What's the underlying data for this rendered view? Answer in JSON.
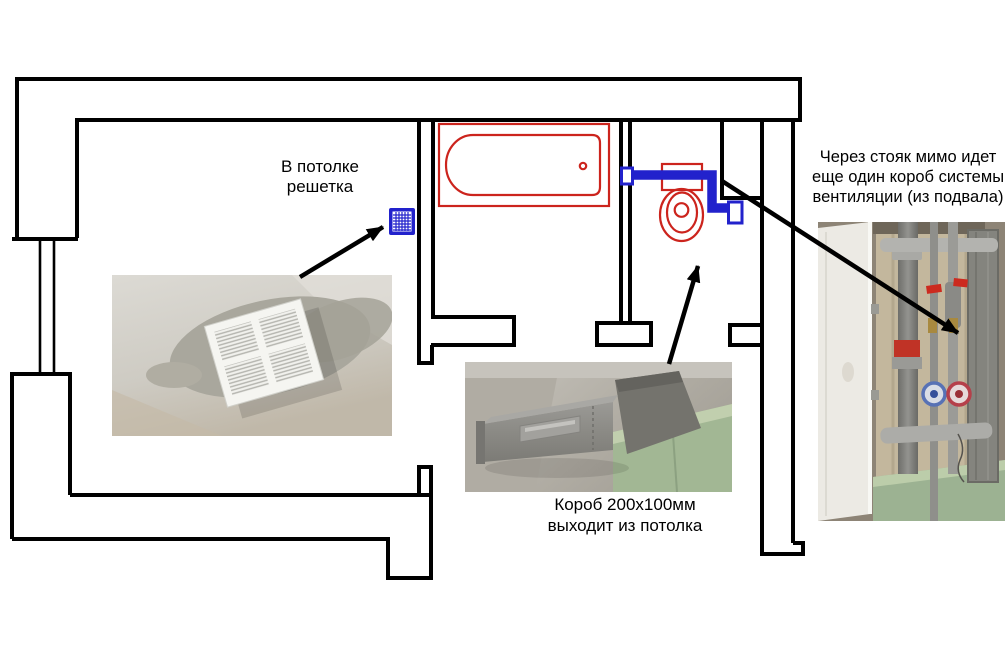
{
  "colors": {
    "background": "#ffffff",
    "wall": "#000000",
    "fixture_red": "#cc241d",
    "vent_blue": "#2222cc",
    "text": "#000000"
  },
  "labels": {
    "ceiling_grille": {
      "line1": "В потолке",
      "line2": "решетка"
    },
    "duct_exit": {
      "line1": "Короб 200х100мм",
      "line2": "выходит из потолка"
    },
    "riser_note": {
      "line1": "Через стояк мимо идет",
      "line2": "еще один короб системы",
      "line3": "вентиляции (из подвала)"
    }
  }
}
